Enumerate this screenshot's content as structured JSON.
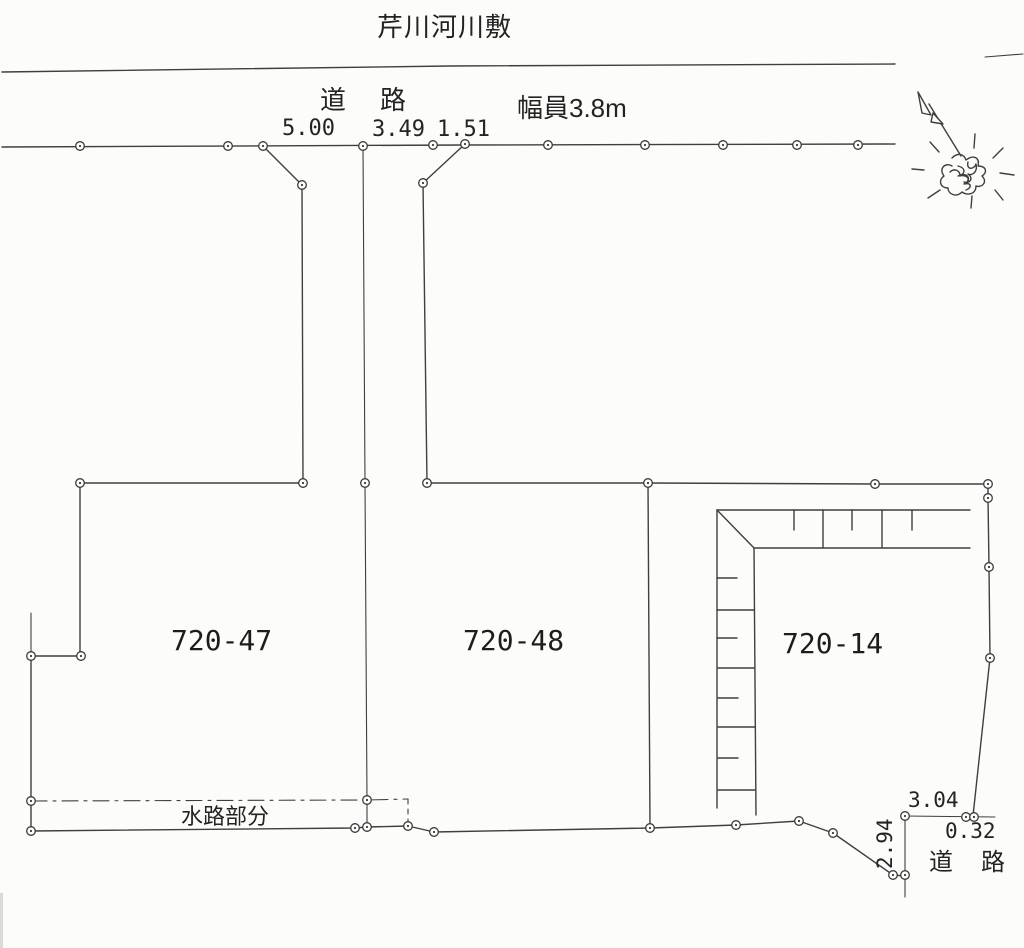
{
  "map": {
    "title": "芹川河川敷",
    "top_road": {
      "label": "道　路",
      "width_label": "幅員3.8m",
      "dims": [
        "5.00",
        "3.49",
        "1.51"
      ]
    },
    "parcels": [
      {
        "id": "720-47"
      },
      {
        "id": "720-48"
      },
      {
        "id": "720-14"
      }
    ],
    "waterway": {
      "label": "水路部分"
    },
    "bottom_road": {
      "label": "道　路",
      "dim_width": "3.04",
      "dim_offset": "0.32",
      "dim_depth": "2.94"
    },
    "colors": {
      "ink": "#232323",
      "line": "#3f3f3f",
      "paper": "#fcfcfa"
    }
  }
}
